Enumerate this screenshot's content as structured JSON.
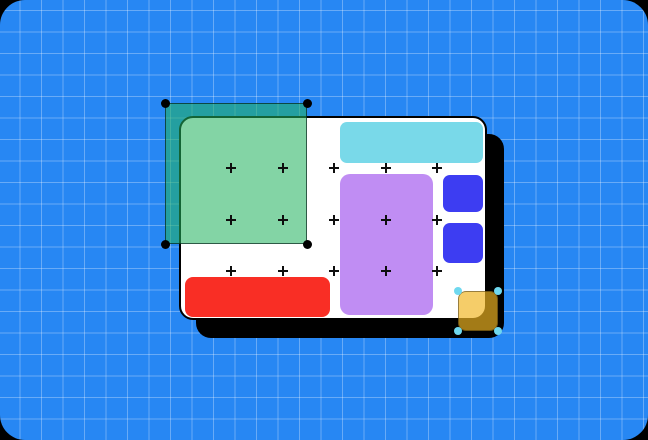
{
  "colors": {
    "page_background": "#000000",
    "board_blue": "#2787F3",
    "grid_line": "rgba(255,255,255,0.30)",
    "artboard_white": "#FFFFFF",
    "artboard_border": "#000000",
    "shadow_black": "#000000",
    "cyan_bar": "#79D9E9",
    "purple_rect": "#C08DF3",
    "blue_square": "#3D3DF2",
    "red_bar": "#F92E25",
    "green_overlay_fill": "rgba(34,178,94,0.56)",
    "green_overlay_border": "rgba(0,25,20,0.65)",
    "black_handle": "#000000",
    "yellow_fill": "rgba(240,182,34,0.68)",
    "yellow_border": "rgba(40,30,10,0.45)",
    "cyan_handle": "#6FD8EF",
    "plus_marker": "#0E0E0E"
  },
  "markers": {
    "plus_grid": {
      "column_centers_px": [
        231,
        282.5,
        334,
        385.5,
        437
      ],
      "row_centers_px": [
        168,
        219.5,
        271
      ]
    }
  },
  "selection": {
    "green_handle_centers_px": [
      [
        165,
        103
      ],
      [
        307,
        103
      ],
      [
        165,
        244
      ],
      [
        307,
        244
      ]
    ],
    "yellow_handle_centers_px": [
      [
        458,
        291
      ],
      [
        498,
        291
      ],
      [
        458,
        331
      ],
      [
        498,
        331
      ]
    ]
  }
}
